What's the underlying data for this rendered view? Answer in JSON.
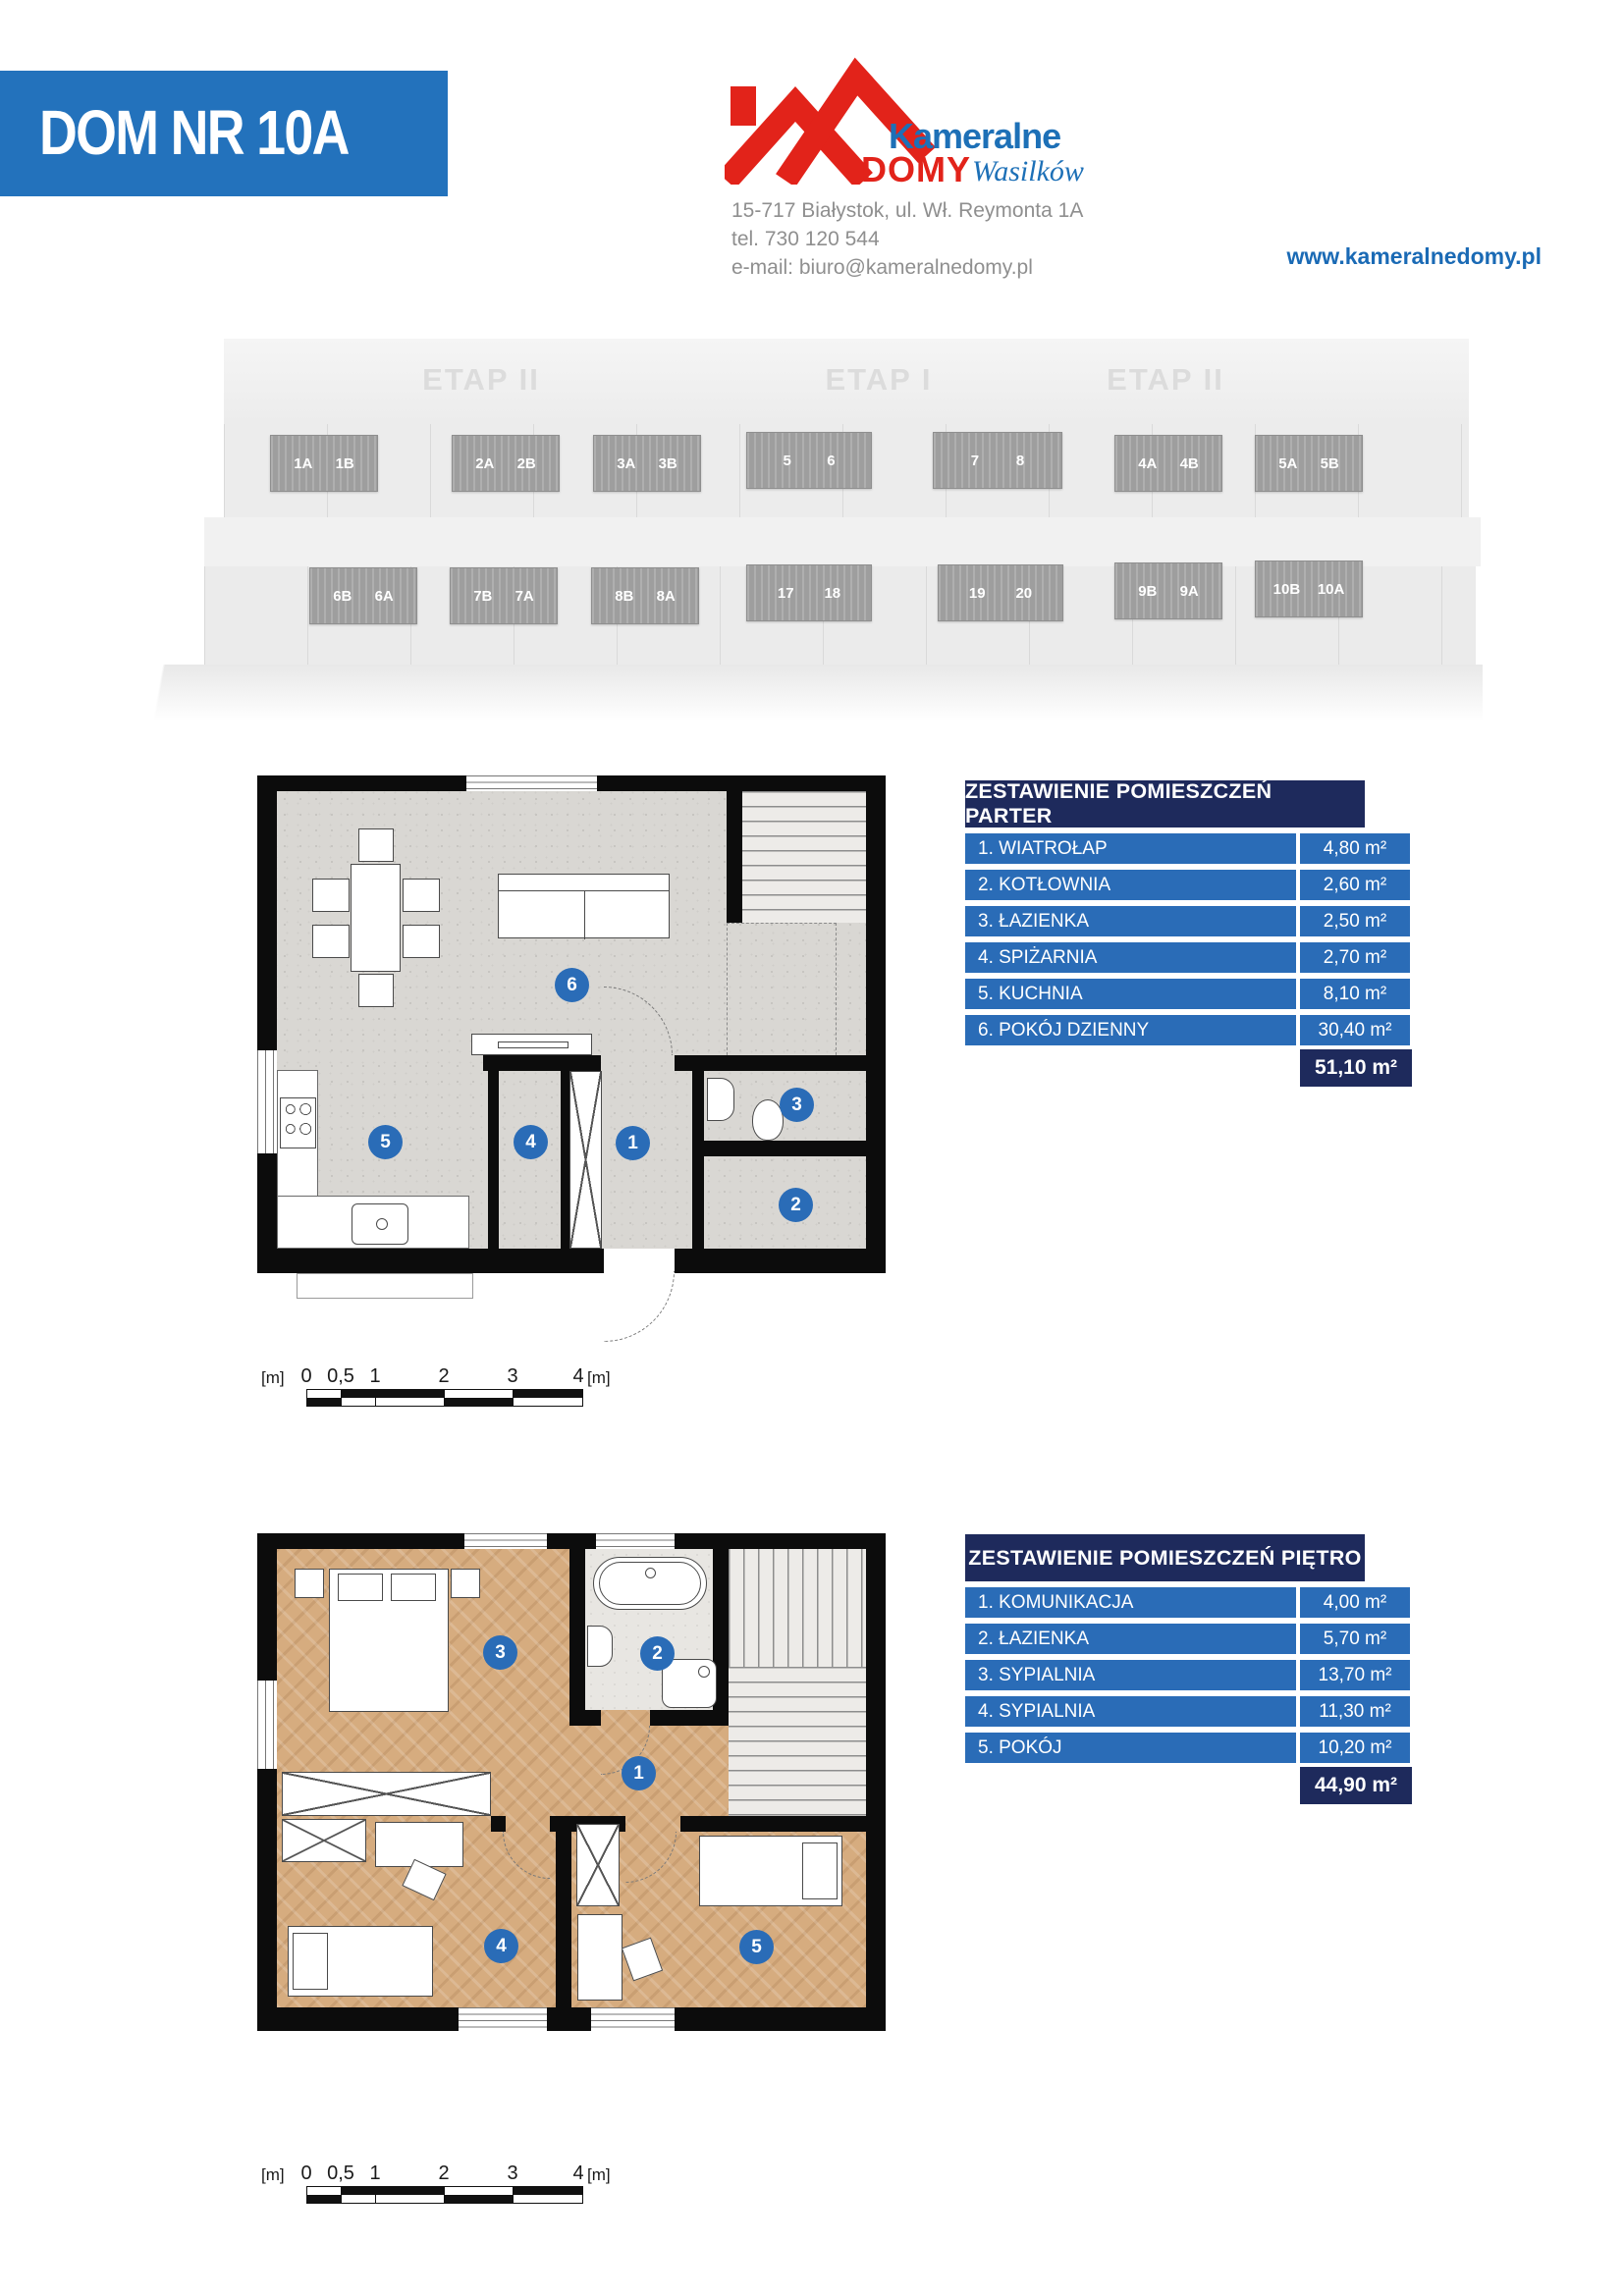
{
  "header": {
    "title": "DOM NR 10A",
    "logo": {
      "word1": "Kameralne",
      "word2": "DOMY",
      "word3": "Wasilków"
    },
    "address_line1": "15-717 Białystok, ul. Wł. Reymonta 1A",
    "address_line2": "tel. 730 120 544",
    "address_line3": "e-mail: biuro@kameralnedomy.pl",
    "website": "www.kameralnedomy.pl"
  },
  "site_plan": {
    "etap_labels": [
      "ETAP II",
      "ETAP I",
      "ETAP II"
    ],
    "top_row": [
      [
        "1A",
        "1B"
      ],
      [
        "2A",
        "2B"
      ],
      [
        "3A",
        "3B"
      ],
      [
        "5",
        "6"
      ],
      [
        "7",
        "8"
      ],
      [
        "4A",
        "4B"
      ],
      [
        "5A",
        "5B"
      ]
    ],
    "bottom_row": [
      [
        "6B",
        "6A"
      ],
      [
        "7B",
        "7A"
      ],
      [
        "8B",
        "8A"
      ],
      [
        "17",
        "18"
      ],
      [
        "19",
        "20"
      ],
      [
        "9B",
        "9A"
      ],
      [
        "10B",
        "10A"
      ]
    ]
  },
  "ground_floor": {
    "markers": [
      "1",
      "2",
      "3",
      "4",
      "5",
      "6"
    ]
  },
  "upper_floor": {
    "markers": [
      "1",
      "2",
      "3",
      "4",
      "5"
    ]
  },
  "tables": {
    "parter": {
      "title": "ZESTAWIENIE POMIESZCZEŃ PARTER",
      "rows": [
        {
          "label": "1. WIATROŁAP",
          "area": "4,80 m²"
        },
        {
          "label": "2. KOTŁOWNIA",
          "area": "2,60 m²"
        },
        {
          "label": "3. ŁAZIENKA",
          "area": "2,50 m²"
        },
        {
          "label": "4. SPIŻARNIA",
          "area": "2,70 m²"
        },
        {
          "label": "5. KUCHNIA",
          "area": "8,10 m²"
        },
        {
          "label": "6. POKÓJ DZIENNY",
          "area": "30,40 m²"
        }
      ],
      "total": "51,10 m²"
    },
    "pietro": {
      "title": "ZESTAWIENIE POMIESZCZEŃ PIĘTRO",
      "rows": [
        {
          "label": "1. KOMUNIKACJA",
          "area": "4,00 m²"
        },
        {
          "label": "2. ŁAZIENKA",
          "area": "5,70 m²"
        },
        {
          "label": "3. SYPIALNIA",
          "area": "13,70 m²"
        },
        {
          "label": "4. SYPIALNIA",
          "area": "11,30 m²"
        },
        {
          "label": "5. POKÓJ",
          "area": "10,20 m²"
        }
      ],
      "total": "44,90 m²"
    }
  },
  "scale_bar": {
    "unit": "[m]",
    "ticks": [
      "0",
      "0,5",
      "1",
      "2",
      "3",
      "4"
    ],
    "end_unit": "[m]"
  },
  "colors": {
    "banner_blue": "#2372bc",
    "table_navy": "#1e2a5c",
    "table_blue": "#2a6cb7",
    "logo_red": "#e2231a",
    "logo_blue": "#1d70b7",
    "link_blue": "#1a6ab5",
    "marker_blue": "#2a6cb7",
    "house_gray": "#9e9e9e"
  }
}
